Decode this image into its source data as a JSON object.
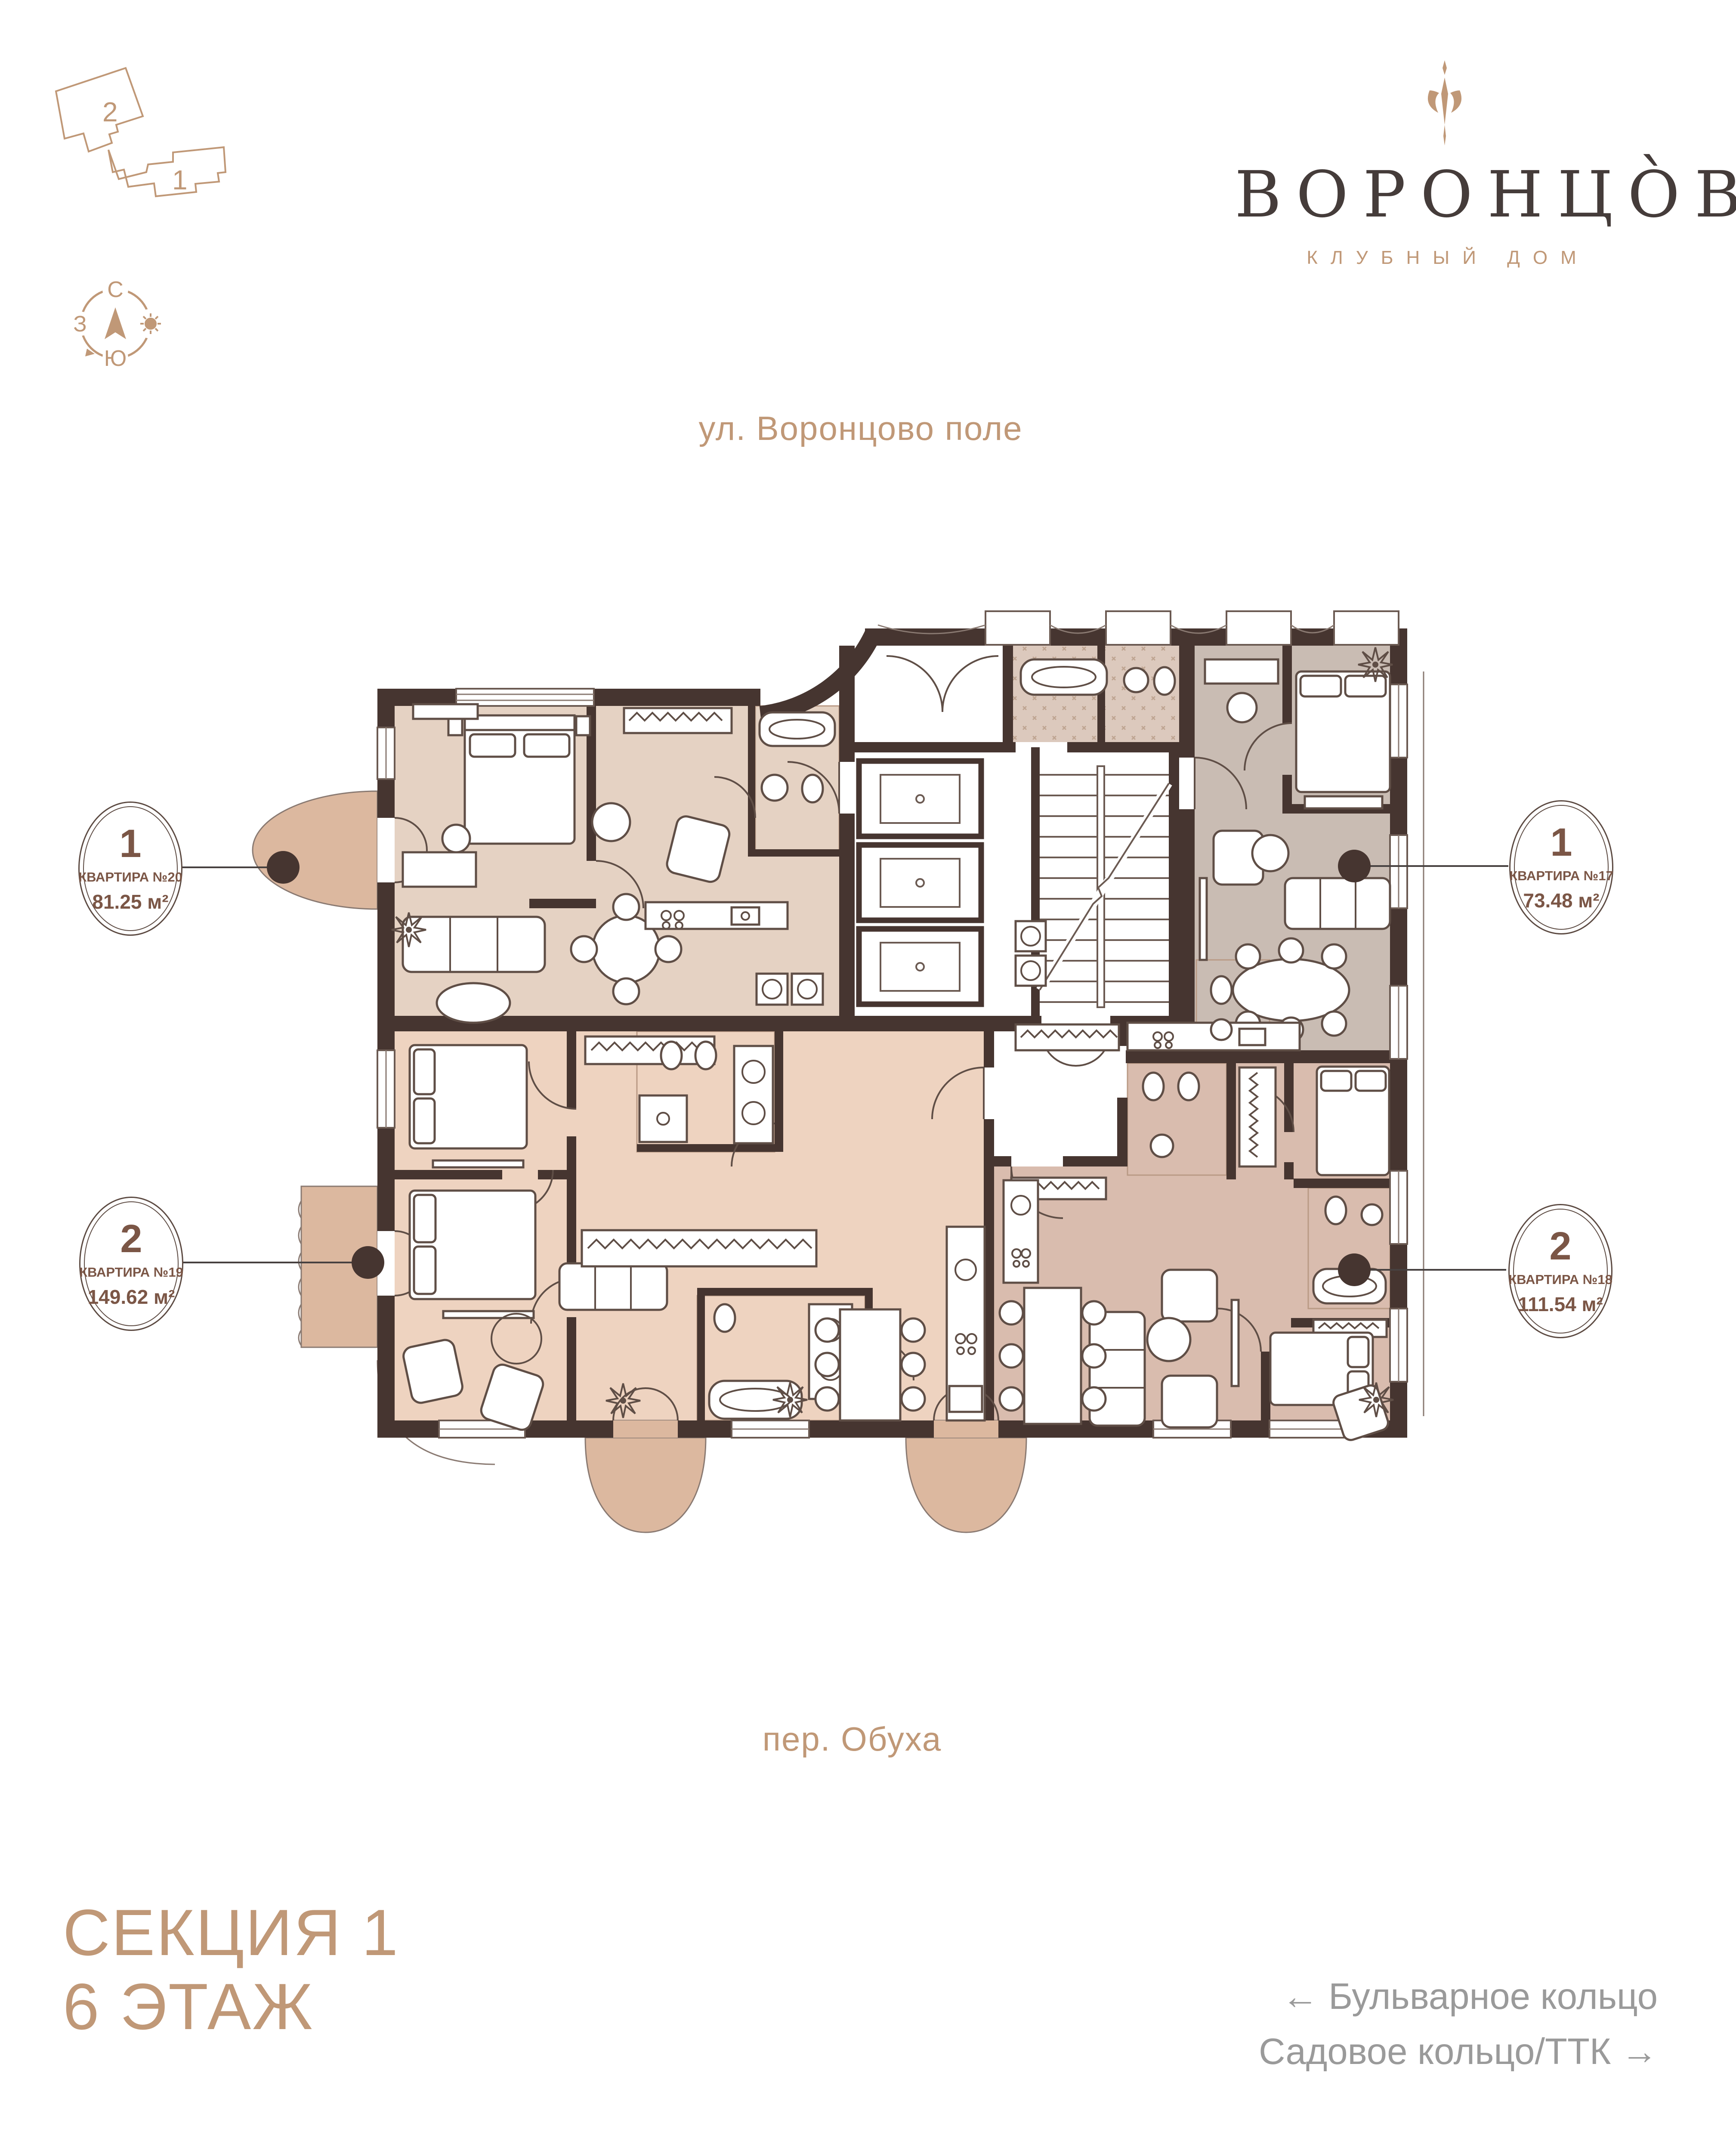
{
  "logo": {
    "title": "ВОРОНЦО̀ВЪ",
    "subtitle": "КЛУБНЫЙ ДОМ"
  },
  "minimap": {
    "section1_label": "1",
    "section2_label": "2"
  },
  "compass": {
    "north": "С",
    "west": "З",
    "south": "Ю"
  },
  "streets": {
    "top": "ул. Воронцово поле",
    "bottom": "пер. Обуха"
  },
  "apartments": [
    {
      "id": "apt-20",
      "rooms": "1",
      "name": "КВАРТИРА №20",
      "area": "81.25 м²"
    },
    {
      "id": "apt-17",
      "rooms": "1",
      "name": "КВАРТИРА №17",
      "area": "73.48 м²"
    },
    {
      "id": "apt-19",
      "rooms": "2",
      "name": "КВАРТИРА №19",
      "area": "149.62 м²"
    },
    {
      "id": "apt-18",
      "rooms": "2",
      "name": "КВАРТИРА №18",
      "area": "111.54 м²"
    }
  ],
  "footer": {
    "section": "СЕКЦИЯ 1",
    "floor": "6 ЭТАЖ",
    "direction_left": "← Бульварное кольцо",
    "direction_right": "Садовое кольцо/ТТК →"
  },
  "colors": {
    "brand_tan": "#c09877",
    "logo_dark": "#453c3a",
    "badge_brown": "#7b5646",
    "wall": "#463530",
    "apt20_fill": "#e5d2c3",
    "apt17_fill": "#c9bcb3",
    "apt19_fill": "#eed3c0",
    "apt18_fill": "#d9bcae",
    "balcony_fill": "#dcb89f",
    "direction_gray": "#9a9a9a"
  }
}
